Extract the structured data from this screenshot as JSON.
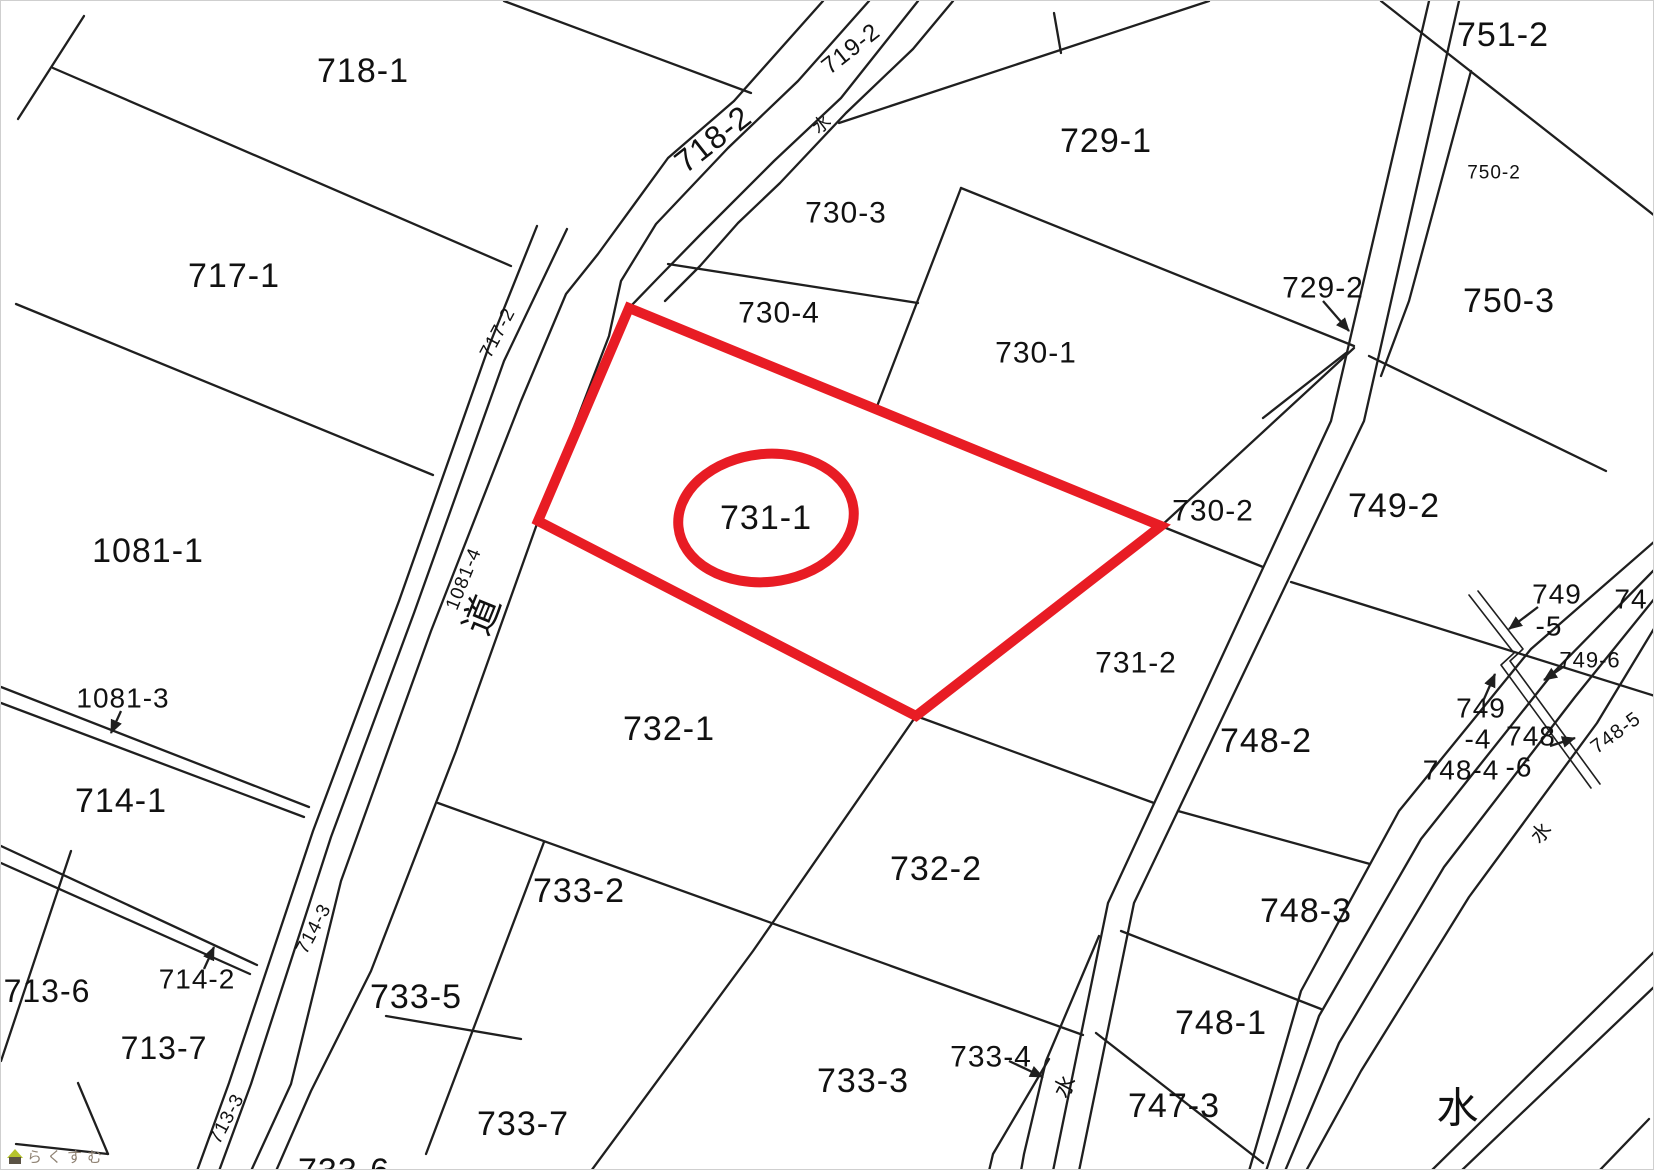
{
  "map": {
    "width": 1654,
    "height": 1170,
    "background": "#ffffff",
    "line_color": "#1f1f1f",
    "text_color": "#111111",
    "highlight": {
      "color": "#e81c24",
      "stroke_width": 10,
      "polygon": [
        [
          628,
          307
        ],
        [
          1160,
          525
        ],
        [
          915,
          715
        ],
        [
          537,
          520
        ]
      ],
      "ellipse": {
        "cx": 765,
        "cy": 517,
        "rx": 88,
        "ry": 64,
        "rot": -6
      },
      "label": "731-1"
    },
    "lines": [
      {
        "p": [
          [
            83,
            15
          ],
          [
            17,
            118
          ]
        ]
      },
      {
        "p": [
          [
            52,
            67
          ],
          [
            510,
            265
          ]
        ]
      },
      {
        "p": [
          [
            503,
            0
          ],
          [
            750,
            92
          ]
        ]
      },
      {
        "p": [
          [
            15,
            303
          ],
          [
            432,
            474
          ]
        ]
      },
      {
        "p": [
          [
            536,
            225
          ],
          [
            488,
            345
          ],
          [
            398,
            600
          ],
          [
            312,
            830
          ],
          [
            228,
            1082
          ],
          [
            196,
            1170
          ]
        ]
      },
      {
        "p": [
          [
            566,
            228
          ],
          [
            503,
            360
          ],
          [
            413,
            612
          ],
          [
            330,
            836
          ],
          [
            250,
            1083
          ],
          [
            218,
            1170
          ]
        ]
      },
      {
        "p": [
          [
            822,
            0
          ],
          [
            733,
            100
          ],
          [
            667,
            157
          ],
          [
            597,
            253
          ],
          [
            565,
            293
          ],
          [
            520,
            400
          ],
          [
            430,
            630
          ],
          [
            340,
            880
          ],
          [
            290,
            1083
          ],
          [
            250,
            1170
          ]
        ]
      },
      {
        "p": [
          [
            868,
            0
          ],
          [
            797,
            80
          ],
          [
            727,
            147
          ],
          [
            655,
            223
          ],
          [
            620,
            280
          ],
          [
            608,
            335
          ],
          [
            537,
            520
          ],
          [
            455,
            750
          ],
          [
            370,
            970
          ],
          [
            310,
            1090
          ],
          [
            275,
            1170
          ]
        ]
      },
      {
        "p": [
          [
            917,
            0
          ],
          [
            840,
            97
          ],
          [
            773,
            160
          ],
          [
            700,
            233
          ],
          [
            657,
            277
          ],
          [
            628,
            307
          ]
        ]
      },
      {
        "p": [
          [
            952,
            0
          ],
          [
            912,
            48
          ],
          [
            845,
            112
          ],
          [
            779,
            182
          ],
          [
            737,
            222
          ],
          [
            699,
            265
          ],
          [
            664,
            300
          ]
        ]
      },
      {
        "p": [
          [
            0,
            686
          ],
          [
            308,
            806
          ]
        ]
      },
      {
        "p": [
          [
            0,
            702
          ],
          [
            303,
            816
          ]
        ]
      },
      {
        "p": [
          [
            0,
            845
          ],
          [
            256,
            964
          ]
        ]
      },
      {
        "p": [
          [
            0,
            862
          ],
          [
            249,
            973
          ]
        ]
      },
      {
        "p": [
          [
            70,
            850
          ],
          [
            0,
            1060
          ]
        ]
      },
      {
        "p": [
          [
            77,
            1082
          ],
          [
            107,
            1153
          ]
        ]
      },
      {
        "p": [
          [
            15,
            1143
          ],
          [
            107,
            1153
          ]
        ]
      },
      {
        "p": [
          [
            838,
            122
          ],
          [
            1208,
            0
          ]
        ]
      },
      {
        "p": [
          [
            1053,
            12
          ],
          [
            1060,
            52
          ]
        ]
      },
      {
        "p": [
          [
            1380,
            0
          ],
          [
            1654,
            215
          ]
        ]
      },
      {
        "p": [
          [
            1428,
            0
          ],
          [
            1330,
            420
          ],
          [
            1107,
            902
          ],
          [
            1052,
            1170
          ]
        ]
      },
      {
        "p": [
          [
            1458,
            0
          ],
          [
            1363,
            420
          ],
          [
            1133,
            902
          ],
          [
            1078,
            1170
          ]
        ]
      },
      {
        "p": [
          [
            1470,
            70
          ],
          [
            1408,
            300
          ],
          [
            1380,
            375
          ]
        ]
      },
      {
        "p": [
          [
            960,
            187
          ],
          [
            1353,
            345
          ]
        ]
      },
      {
        "p": [
          [
            1262,
            417
          ],
          [
            1345,
            352
          ]
        ]
      },
      {
        "p": [
          [
            1368,
            355
          ],
          [
            1605,
            470
          ]
        ]
      },
      {
        "p": [
          [
            1654,
            540
          ],
          [
            1530,
            648
          ],
          [
            1398,
            810
          ],
          [
            1300,
            990
          ],
          [
            1248,
            1170
          ]
        ]
      },
      {
        "p": [
          [
            1654,
            568
          ],
          [
            1552,
            672
          ],
          [
            1420,
            838
          ],
          [
            1318,
            1015
          ],
          [
            1265,
            1170
          ]
        ]
      },
      {
        "p": [
          [
            1654,
            597
          ],
          [
            1574,
            696
          ],
          [
            1443,
            866
          ],
          [
            1338,
            1042
          ],
          [
            1284,
            1170
          ]
        ]
      },
      {
        "p": [
          [
            1654,
            626
          ],
          [
            1596,
            722
          ],
          [
            1468,
            896
          ],
          [
            1360,
            1070
          ],
          [
            1305,
            1170
          ]
        ]
      },
      {
        "p": [
          [
            1654,
            950
          ],
          [
            1430,
            1170
          ]
        ]
      },
      {
        "p": [
          [
            1654,
            985
          ],
          [
            1460,
            1170
          ]
        ]
      },
      {
        "p": [
          [
            1648,
            1118
          ],
          [
            1598,
            1170
          ]
        ]
      },
      {
        "p": [
          [
            1468,
            594
          ],
          [
            1513,
            652
          ],
          [
            1500,
            664
          ],
          [
            1590,
            787
          ]
        ],
        "w": 1.6
      },
      {
        "p": [
          [
            1477,
            590
          ],
          [
            1522,
            648
          ],
          [
            1509,
            660
          ],
          [
            1599,
            783
          ]
        ],
        "w": 1.6
      },
      {
        "p": [
          [
            1290,
            581
          ],
          [
            1654,
            695
          ]
        ]
      },
      {
        "p": [
          [
            1177,
            810
          ],
          [
            1369,
            863
          ]
        ]
      },
      {
        "p": [
          [
            1120,
            930
          ],
          [
            1320,
            1008
          ]
        ]
      },
      {
        "p": [
          [
            1095,
            1032
          ],
          [
            1262,
            1162
          ]
        ]
      },
      {
        "p": [
          [
            915,
            715
          ],
          [
            752,
            950
          ],
          [
            590,
            1170
          ]
        ]
      },
      {
        "p": [
          [
            437,
            802
          ],
          [
            1082,
            1034
          ]
        ]
      },
      {
        "p": [
          [
            915,
            715
          ],
          [
            1153,
            802
          ]
        ]
      },
      {
        "p": [
          [
            1098,
            935
          ],
          [
            1045,
            1060
          ],
          [
            1023,
            1153
          ],
          [
            1020,
            1170
          ]
        ]
      },
      {
        "p": [
          [
            1048,
            1058
          ],
          [
            992,
            1153
          ],
          [
            988,
            1170
          ]
        ]
      },
      {
        "p": [
          [
            543,
            841
          ],
          [
            425,
            1153
          ]
        ]
      },
      {
        "p": [
          [
            385,
            1015
          ],
          [
            520,
            1038
          ]
        ]
      },
      {
        "p": [
          [
            960,
            187
          ],
          [
            875,
            408
          ]
        ]
      },
      {
        "p": [
          [
            667,
            263
          ],
          [
            917,
            302
          ]
        ]
      },
      {
        "p": [
          [
            1160,
            525
          ],
          [
            1353,
            347
          ]
        ]
      },
      {
        "p": [
          [
            1160,
            525
          ],
          [
            1262,
            566
          ]
        ]
      }
    ],
    "arrows": [
      {
        "x1": 120,
        "y1": 710,
        "x2": 110,
        "y2": 732
      },
      {
        "x1": 203,
        "y1": 968,
        "x2": 213,
        "y2": 946
      },
      {
        "x1": 1322,
        "y1": 300,
        "x2": 1348,
        "y2": 330
      },
      {
        "x1": 1008,
        "y1": 1060,
        "x2": 1042,
        "y2": 1076
      },
      {
        "x1": 1537,
        "y1": 606,
        "x2": 1508,
        "y2": 628
      },
      {
        "x1": 1562,
        "y1": 666,
        "x2": 1543,
        "y2": 679
      },
      {
        "x1": 1483,
        "y1": 698,
        "x2": 1494,
        "y2": 673
      },
      {
        "x1": 1549,
        "y1": 745,
        "x2": 1574,
        "y2": 737
      }
    ],
    "labels": [
      {
        "t": "718-1",
        "x": 362,
        "y": 70,
        "s": 34
      },
      {
        "t": "717-1",
        "x": 233,
        "y": 275,
        "s": 34
      },
      {
        "t": "1081-1",
        "x": 147,
        "y": 550,
        "s": 34
      },
      {
        "t": "1081-3",
        "x": 122,
        "y": 697,
        "s": 28
      },
      {
        "t": "714-1",
        "x": 120,
        "y": 800,
        "s": 34
      },
      {
        "t": "714-2",
        "x": 196,
        "y": 978,
        "s": 28
      },
      {
        "t": "713-6",
        "x": 46,
        "y": 990,
        "s": 32
      },
      {
        "t": "713-7",
        "x": 163,
        "y": 1047,
        "s": 32
      },
      {
        "t": "718-2",
        "x": 712,
        "y": 138,
        "s": 32,
        "r": -38
      },
      {
        "t": "719-2",
        "x": 850,
        "y": 48,
        "s": 24,
        "r": -38
      },
      {
        "t": "水",
        "x": 821,
        "y": 123,
        "s": 18,
        "r": -38
      },
      {
        "t": "717-2",
        "x": 497,
        "y": 332,
        "s": 19,
        "r": -62
      },
      {
        "t": "1081-4",
        "x": 463,
        "y": 578,
        "s": 19,
        "r": -68
      },
      {
        "t": "道",
        "x": 482,
        "y": 614,
        "s": 38,
        "r": -68
      },
      {
        "t": "714-3",
        "x": 313,
        "y": 928,
        "s": 19,
        "r": -62
      },
      {
        "t": "713-3",
        "x": 226,
        "y": 1118,
        "s": 19,
        "r": -62
      },
      {
        "t": "730-3",
        "x": 845,
        "y": 212,
        "s": 30
      },
      {
        "t": "730-4",
        "x": 778,
        "y": 312,
        "s": 30
      },
      {
        "t": "730-1",
        "x": 1035,
        "y": 352,
        "s": 30
      },
      {
        "t": "729-1",
        "x": 1105,
        "y": 140,
        "s": 34
      },
      {
        "t": "729-2",
        "x": 1322,
        "y": 287,
        "s": 30
      },
      {
        "t": "751-2",
        "x": 1502,
        "y": 34,
        "s": 34
      },
      {
        "t": "750-2",
        "x": 1493,
        "y": 172,
        "s": 19
      },
      {
        "t": "750-3",
        "x": 1508,
        "y": 300,
        "s": 34
      },
      {
        "t": "749-2",
        "x": 1393,
        "y": 505,
        "s": 34
      },
      {
        "t": "730-2",
        "x": 1212,
        "y": 510,
        "s": 30
      },
      {
        "t": "731-1",
        "x": 765,
        "y": 517,
        "s": 34
      },
      {
        "t": "731-2",
        "x": 1135,
        "y": 662,
        "s": 30
      },
      {
        "t": "732-1",
        "x": 668,
        "y": 728,
        "s": 34
      },
      {
        "t": "733-2",
        "x": 578,
        "y": 890,
        "s": 34
      },
      {
        "t": "732-2",
        "x": 935,
        "y": 868,
        "s": 34
      },
      {
        "t": "733-5",
        "x": 415,
        "y": 996,
        "s": 34
      },
      {
        "t": "733-7",
        "x": 522,
        "y": 1123,
        "s": 34
      },
      {
        "t": "733-6",
        "x": 343,
        "y": 1170,
        "s": 34
      },
      {
        "t": "733-3",
        "x": 862,
        "y": 1080,
        "s": 34
      },
      {
        "t": "733-4",
        "x": 990,
        "y": 1056,
        "s": 30
      },
      {
        "t": "水",
        "x": 1064,
        "y": 1085,
        "s": 22,
        "r": -62
      },
      {
        "t": "747-3",
        "x": 1173,
        "y": 1105,
        "s": 34
      },
      {
        "t": "748-1",
        "x": 1220,
        "y": 1022,
        "s": 34
      },
      {
        "t": "748-3",
        "x": 1305,
        "y": 910,
        "s": 34
      },
      {
        "t": "748-2",
        "x": 1265,
        "y": 740,
        "s": 34
      },
      {
        "t": "749",
        "x": 1556,
        "y": 593,
        "s": 28
      },
      {
        "t": "-5",
        "x": 1548,
        "y": 625,
        "s": 28
      },
      {
        "t": "749-6",
        "x": 1589,
        "y": 659,
        "s": 22
      },
      {
        "t": "749",
        "x": 1480,
        "y": 707,
        "s": 28
      },
      {
        "t": "-4",
        "x": 1477,
        "y": 738,
        "s": 28
      },
      {
        "t": "748",
        "x": 1530,
        "y": 735,
        "s": 28
      },
      {
        "t": "-6",
        "x": 1518,
        "y": 766,
        "s": 28
      },
      {
        "t": "748-4",
        "x": 1460,
        "y": 769,
        "s": 28
      },
      {
        "t": "748-5",
        "x": 1615,
        "y": 732,
        "s": 20,
        "r": -36
      },
      {
        "t": "74",
        "x": 1630,
        "y": 598,
        "s": 28
      },
      {
        "t": "水",
        "x": 1541,
        "y": 832,
        "s": 20,
        "r": -48
      },
      {
        "t": "水",
        "x": 1457,
        "y": 1107,
        "s": 42
      }
    ]
  },
  "watermark": {
    "text": "らくすむ",
    "text_color": "#8f8273",
    "roof_color": "#b5c32d",
    "body_color": "#5a5244"
  }
}
